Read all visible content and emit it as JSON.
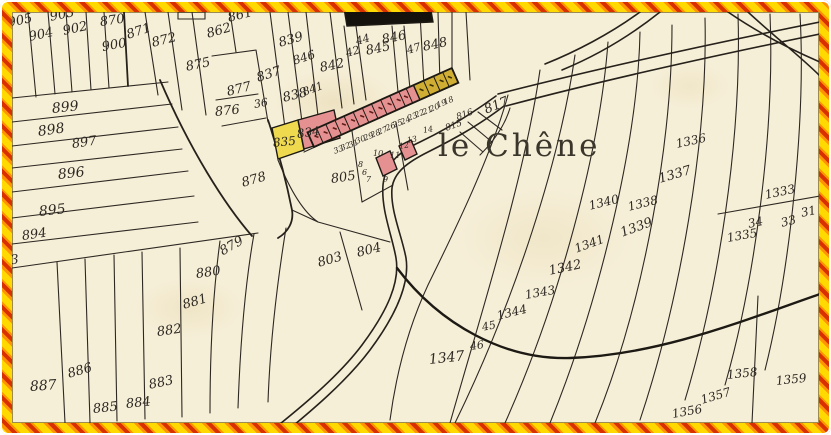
{
  "map": {
    "place_name": "le Chêne",
    "colors": {
      "border_yellow": "#ffd900",
      "border_orange": "#ff9300",
      "border_red": "#d93000",
      "paper": "#f6efd8",
      "ink": "#2d2822",
      "building_pink": "#e69191",
      "building_yellow": "#cfae33",
      "parcel_yellow": "#eed94f",
      "building_black": "#15120e"
    },
    "place_label_pos": {
      "x": 438,
      "y": 128
    },
    "labels": [
      [
        "905",
        8,
        17,
        13,
        -12
      ],
      [
        "904",
        29,
        31,
        13,
        -12
      ],
      [
        "903",
        50,
        11,
        13,
        -12
      ],
      [
        "902",
        63,
        25,
        13,
        -12
      ],
      [
        "870",
        100,
        16,
        13,
        -8
      ],
      [
        "900",
        102,
        41,
        13,
        -10
      ],
      [
        "871",
        127,
        29,
        13,
        -18
      ],
      [
        "872",
        152,
        37,
        13,
        -14
      ],
      [
        "875",
        186,
        61,
        13,
        -12
      ],
      [
        "861",
        228,
        12,
        13,
        -14
      ],
      [
        "862",
        207,
        28,
        13,
        -16
      ],
      [
        "877",
        227,
        86,
        13,
        -14
      ],
      [
        "876",
        215,
        106,
        13,
        -6
      ],
      [
        "36",
        254,
        99,
        11,
        -10
      ],
      [
        "837",
        257,
        72,
        13,
        -18
      ],
      [
        "838",
        283,
        92,
        13,
        -14
      ],
      [
        "841",
        303,
        87,
        11,
        -20
      ],
      [
        "839",
        279,
        37,
        13,
        -16
      ],
      [
        "846",
        293,
        55,
        12,
        -18
      ],
      [
        "842",
        320,
        62,
        13,
        -12
      ],
      [
        "44",
        356,
        36,
        11,
        -16
      ],
      [
        "42",
        346,
        48,
        11,
        -16
      ],
      [
        "845",
        366,
        45,
        13,
        -12
      ],
      [
        "846",
        382,
        34,
        13,
        -12
      ],
      [
        "47",
        407,
        45,
        11,
        -16
      ],
      [
        "848",
        423,
        41,
        13,
        -12
      ],
      [
        "835",
        273,
        137,
        12,
        -6
      ],
      [
        "834",
        297,
        128,
        12,
        -8
      ],
      [
        "817",
        485,
        104,
        13,
        -22
      ],
      [
        "816",
        457,
        114,
        9,
        -20
      ],
      [
        "815",
        446,
        125,
        9,
        -20
      ],
      [
        "805",
        331,
        173,
        13,
        -8
      ],
      [
        "878",
        242,
        177,
        13,
        -16
      ],
      [
        "899",
        52,
        102,
        14,
        -6
      ],
      [
        "898",
        38,
        125,
        14,
        -8
      ],
      [
        "897",
        72,
        138,
        13,
        -8
      ],
      [
        "896",
        58,
        168,
        14,
        -6
      ],
      [
        "895",
        39,
        205,
        14,
        -6
      ],
      [
        "894",
        22,
        230,
        13,
        -8
      ],
      [
        "893",
        -6,
        256,
        13,
        -6
      ],
      [
        "879",
        221,
        246,
        13,
        -30
      ],
      [
        "880",
        196,
        268,
        13,
        -8
      ],
      [
        "881",
        183,
        299,
        13,
        -16
      ],
      [
        "882",
        157,
        326,
        13,
        -8
      ],
      [
        "883",
        149,
        379,
        13,
        -12
      ],
      [
        "884",
        126,
        398,
        13,
        -6
      ],
      [
        "885",
        93,
        403,
        13,
        -6
      ],
      [
        "886",
        68,
        368,
        13,
        -16
      ],
      [
        "887",
        30,
        380,
        14,
        -4
      ],
      [
        "803",
        318,
        257,
        13,
        -16
      ],
      [
        "804",
        357,
        247,
        13,
        -14
      ],
      [
        "1336",
        676,
        138,
        12,
        -12
      ],
      [
        "1337",
        659,
        173,
        13,
        -16
      ],
      [
        "1340",
        589,
        200,
        12,
        -14
      ],
      [
        "1338",
        628,
        201,
        12,
        -14
      ],
      [
        "1339",
        621,
        227,
        13,
        -20
      ],
      [
        "1333",
        765,
        189,
        12,
        -12
      ],
      [
        "34",
        748,
        218,
        12,
        -12
      ],
      [
        "1335",
        727,
        232,
        12,
        -10
      ],
      [
        "33",
        781,
        217,
        12,
        -14
      ],
      [
        "31",
        801,
        207,
        12,
        -12
      ],
      [
        "1341",
        575,
        243,
        12,
        -20
      ],
      [
        "1342",
        549,
        265,
        13,
        -12
      ],
      [
        "1343",
        525,
        289,
        12,
        -10
      ],
      [
        "1344",
        497,
        310,
        12,
        -14
      ],
      [
        "45",
        482,
        322,
        11,
        -12
      ],
      [
        "46",
        470,
        341,
        11,
        -8
      ],
      [
        "1347",
        429,
        353,
        14,
        -6
      ],
      [
        "1358",
        727,
        369,
        12,
        -6
      ],
      [
        "1359",
        776,
        375,
        12,
        -6
      ],
      [
        "1357",
        701,
        394,
        12,
        -16
      ],
      [
        "1356",
        672,
        408,
        12,
        -10
      ],
      [
        "33",
        334,
        148,
        8,
        -22
      ],
      [
        "32",
        341,
        145,
        8,
        -22
      ],
      [
        "31",
        349,
        142,
        8,
        -22
      ],
      [
        "30",
        356,
        138,
        8,
        -22
      ],
      [
        "29",
        364,
        135,
        8,
        -22
      ],
      [
        "28",
        371,
        132,
        8,
        -22
      ],
      [
        "27",
        378,
        129,
        8,
        -22
      ],
      [
        "26",
        386,
        125,
        8,
        -22
      ],
      [
        "25",
        393,
        122,
        8,
        -22
      ],
      [
        "24",
        401,
        119,
        8,
        -22
      ],
      [
        "23",
        408,
        115,
        8,
        -22
      ],
      [
        "22",
        415,
        112,
        8,
        -22
      ],
      [
        "21",
        423,
        109,
        8,
        -22
      ],
      [
        "20",
        430,
        106,
        8,
        -22
      ],
      [
        "19",
        437,
        102,
        8,
        -22
      ],
      [
        "18",
        444,
        99,
        8,
        -22
      ],
      [
        "14",
        423,
        127,
        8,
        -10
      ],
      [
        "13",
        407,
        137,
        8,
        -10
      ],
      [
        "12",
        399,
        143,
        8,
        -10
      ],
      [
        "11",
        390,
        152,
        8,
        0
      ],
      [
        "10",
        373,
        150,
        8,
        0
      ],
      [
        "9",
        383,
        176,
        8,
        0
      ],
      [
        "8",
        358,
        161,
        8,
        0
      ],
      [
        "7",
        366,
        176,
        8,
        0
      ],
      [
        "6",
        362,
        169,
        8,
        0
      ]
    ]
  }
}
